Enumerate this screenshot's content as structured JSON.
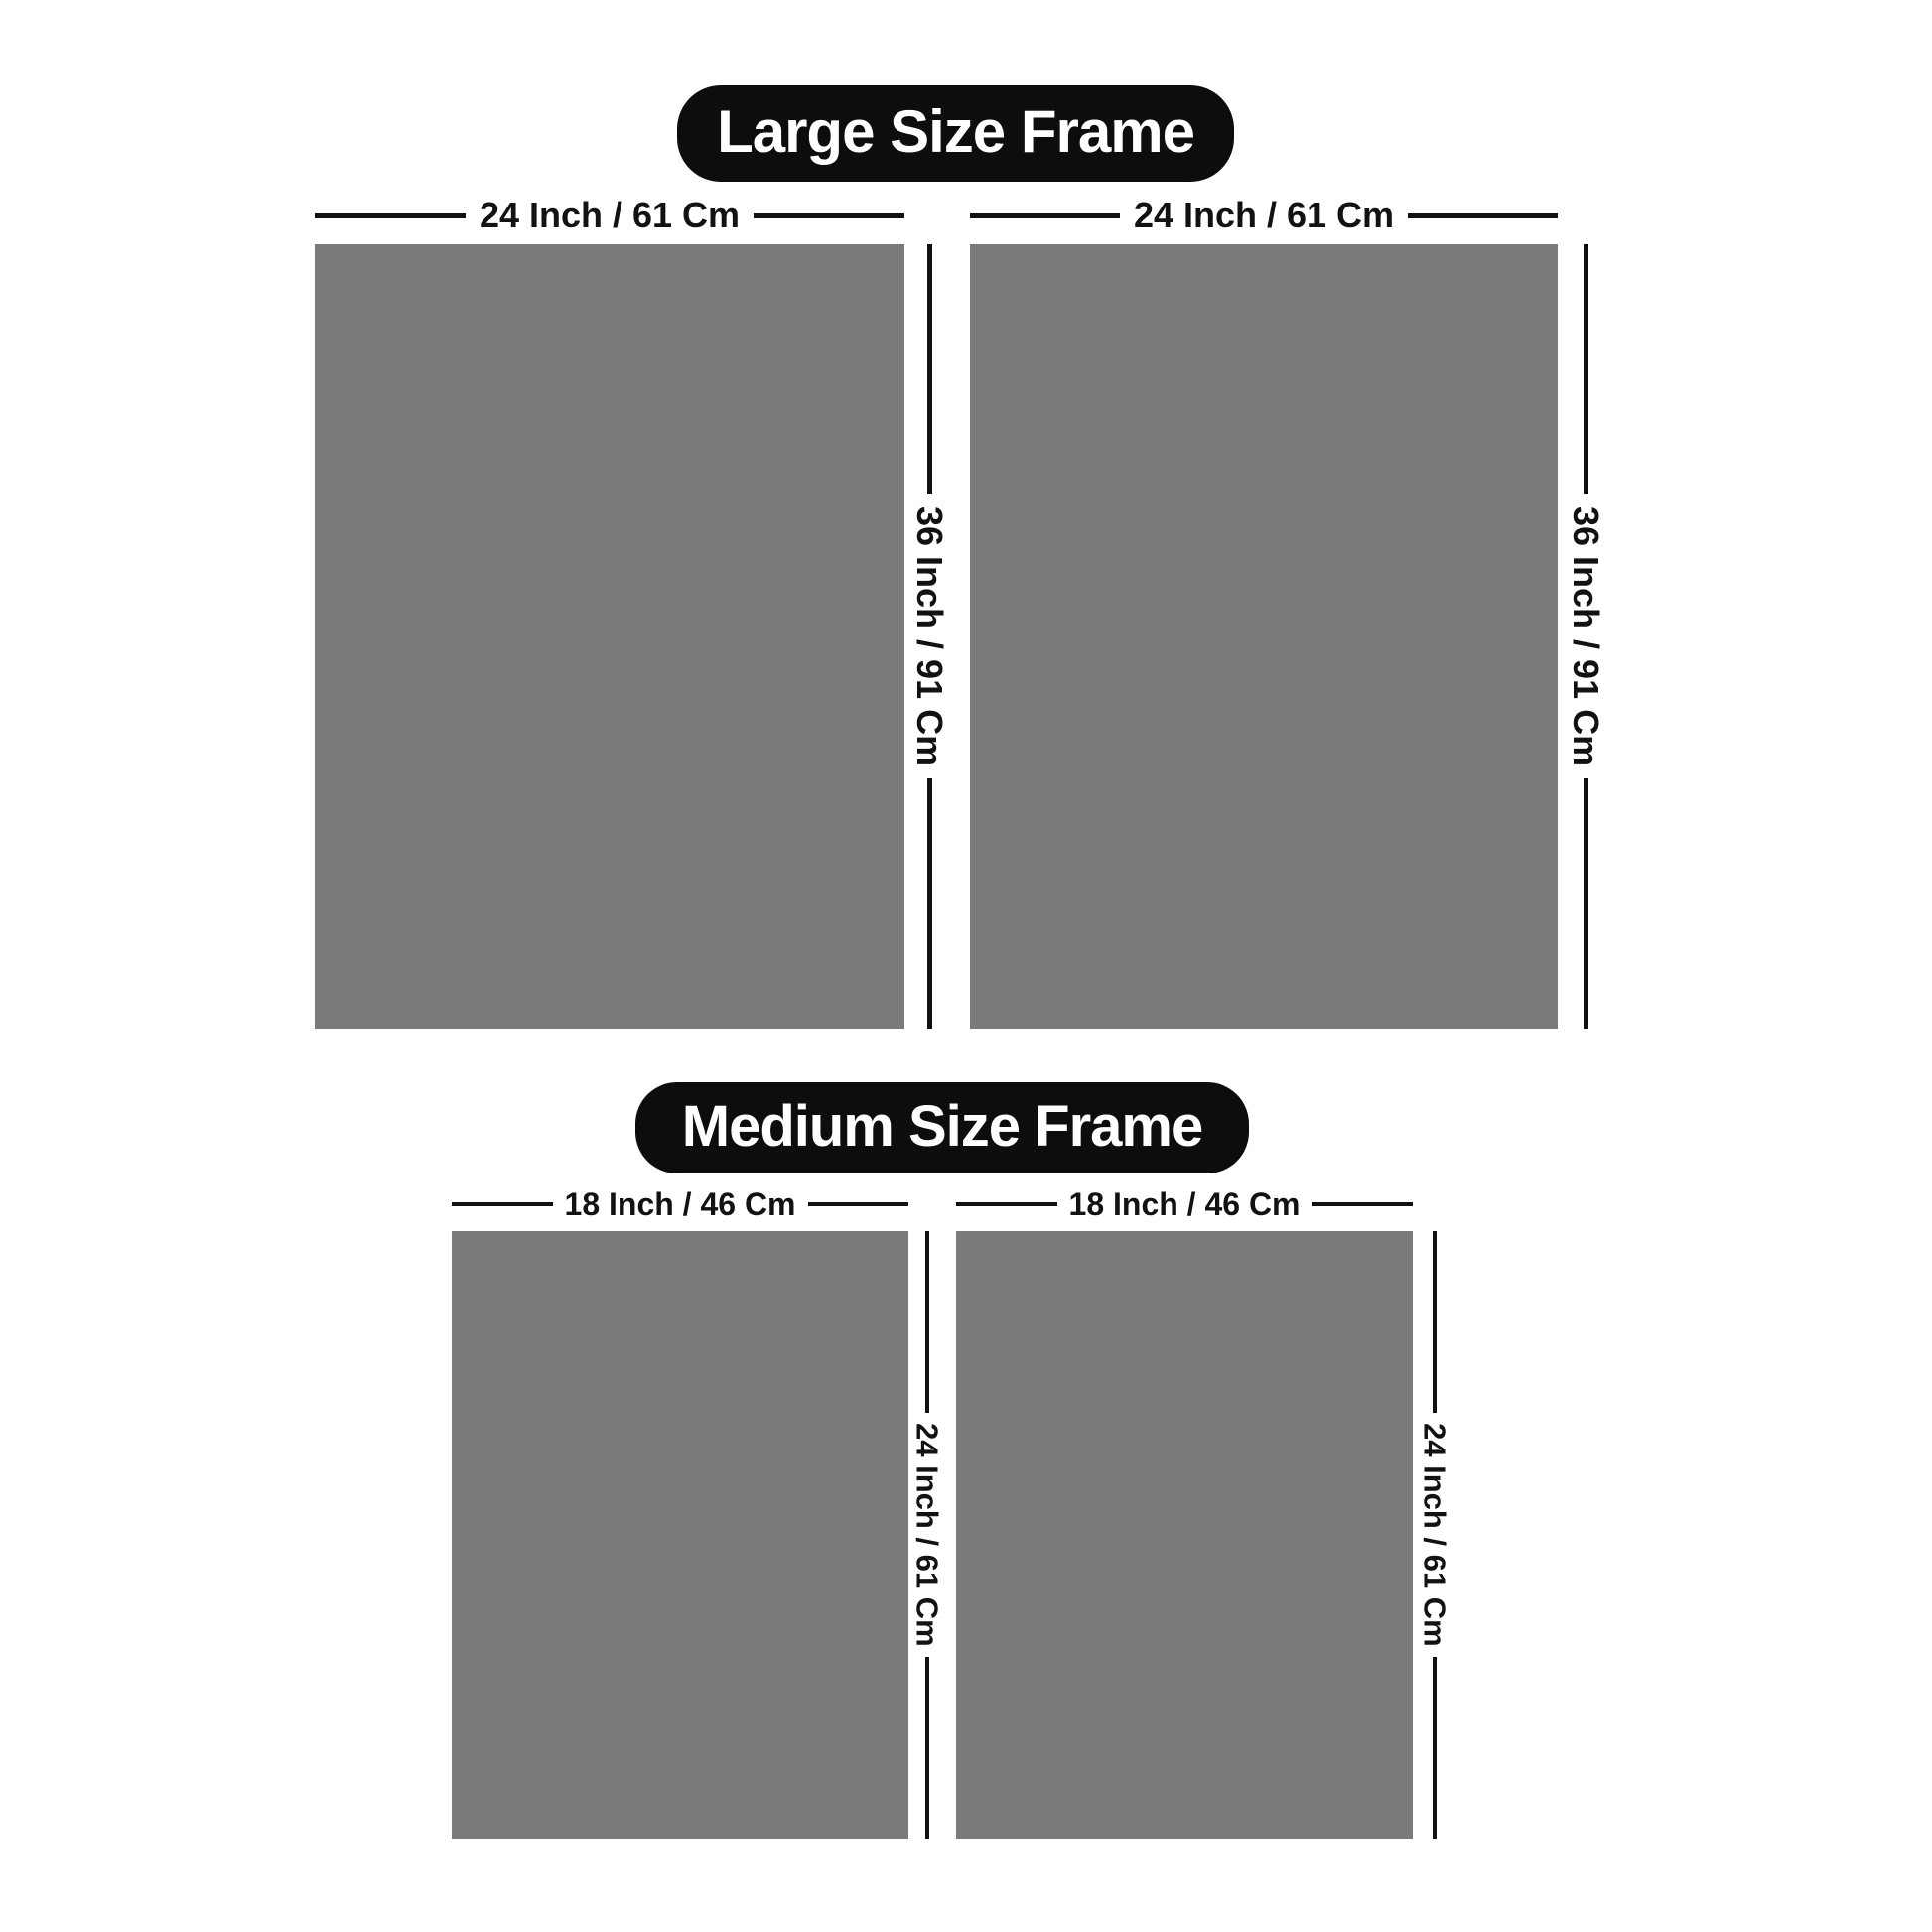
{
  "colors": {
    "page_bg": "#ffffff",
    "frame_gray": "#7a7a7a",
    "pill_bg": "#0d0d0d",
    "pill_text": "#ffffff",
    "line_color": "#121212",
    "label_color": "#121212"
  },
  "sections": [
    {
      "id": "large",
      "title": "Large Size Frame",
      "frames": [
        {
          "width_label": "24 Inch / 61 Cm",
          "height_label": "36 Inch / 91 Cm"
        },
        {
          "width_label": "24 Inch / 61 Cm",
          "height_label": "36 Inch / 91 Cm"
        }
      ]
    },
    {
      "id": "medium",
      "title": "Medium Size Frame",
      "frames": [
        {
          "width_label": "18 Inch / 46 Cm",
          "height_label": "24 Inch / 61 Cm"
        },
        {
          "width_label": "18 Inch / 46 Cm",
          "height_label": "24 Inch / 61 Cm"
        }
      ]
    }
  ]
}
